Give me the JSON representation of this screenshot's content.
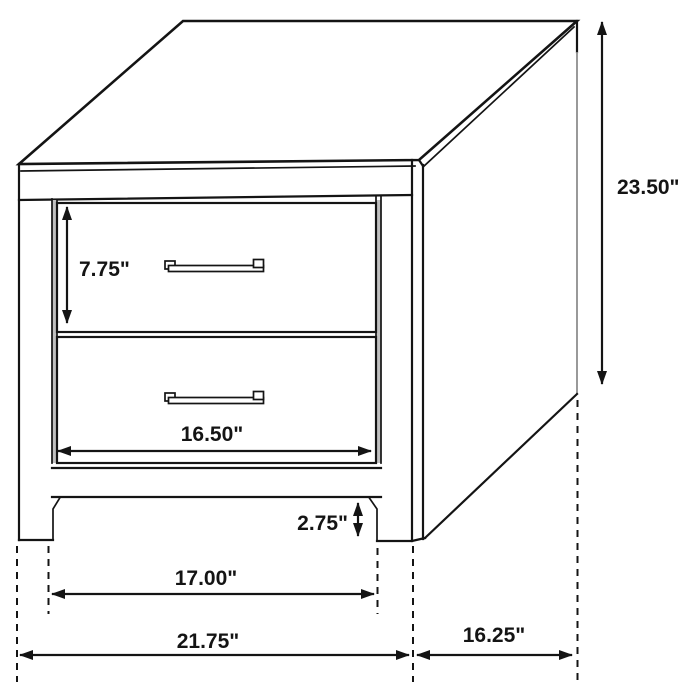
{
  "drawing": {
    "kind": "furniture-dimension-line-drawing",
    "subject": "two-drawer nightstand",
    "units": "inches"
  },
  "colors": {
    "line": "#141414",
    "background": "#ffffff",
    "reveal_gray": "#c0c0c0",
    "side_edge_gray": "#8e8e8e"
  },
  "dimensions": {
    "drawer_height": {
      "label": "7.75\"",
      "value": 7.75
    },
    "overall_height": {
      "label": "23.50\"",
      "value": 23.5
    },
    "drawer_width": {
      "label": "16.50\"",
      "value": 16.5
    },
    "base_clearance": {
      "label": "2.75\"",
      "value": 2.75
    },
    "leg_span": {
      "label": "17.00\"",
      "value": 17.0
    },
    "overall_width": {
      "label": "21.75\"",
      "value": 21.75
    },
    "overall_depth": {
      "label": "16.25\"",
      "value": 16.25
    }
  }
}
